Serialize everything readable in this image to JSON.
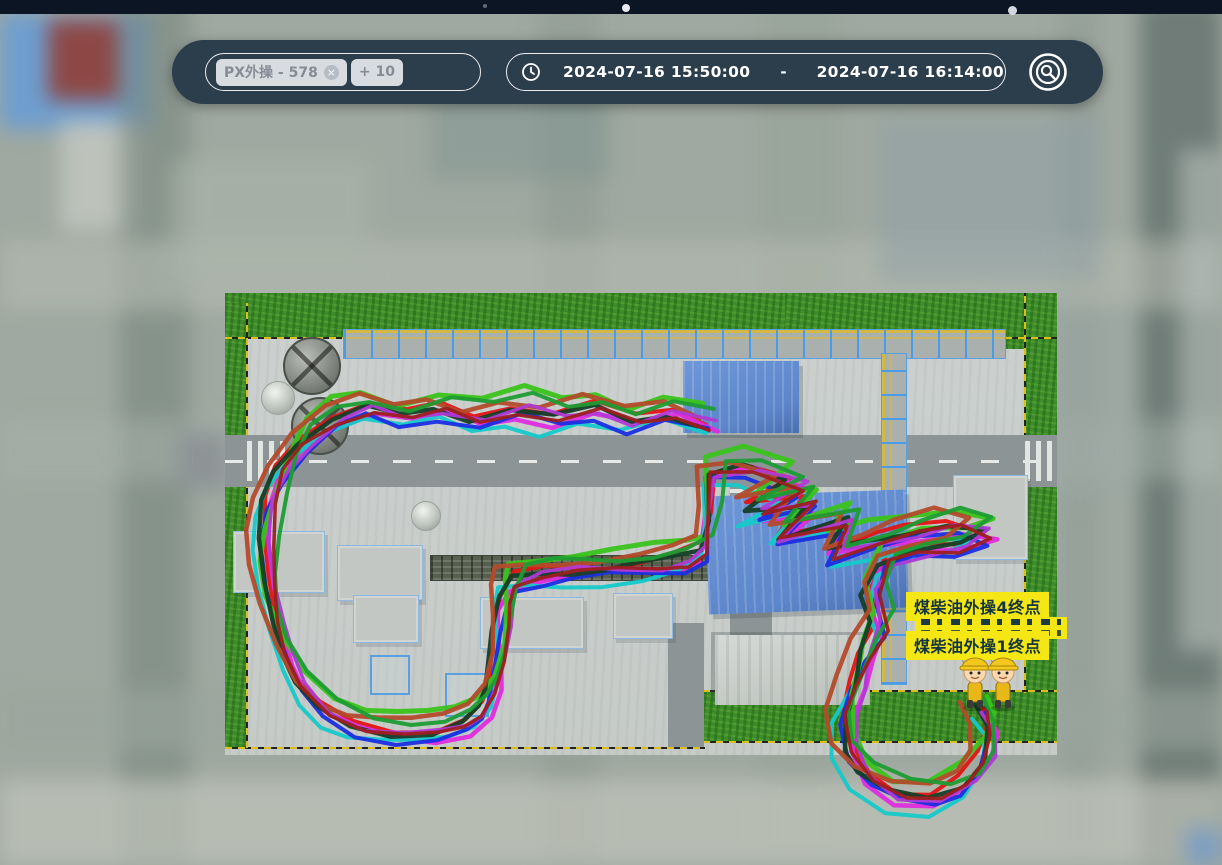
{
  "toolbar": {
    "person_filter": {
      "tag": "PX外操 - 578",
      "remove_icon": "×",
      "more_badge": "+ 10"
    },
    "time_range": {
      "start": "2024-07-16 15:50:00",
      "separator": "-",
      "end": "2024-07-16 16:14:00"
    }
  },
  "map": {
    "endpoint_labels": {
      "label_4": "煤柴油外操4终点",
      "label_1": "煤柴油外操1终点",
      "clipped_rows": 2
    },
    "workers_count": 2,
    "colors": {
      "label_bg": "#f5e713",
      "label_text": "#143441",
      "toolbar_bg": "#2c3d4c",
      "topbar_bg": "#0b1524",
      "grass": "#3f8c2b",
      "blue_roof": "#5d86cb"
    },
    "trajectories": {
      "base_points": [
        [
          706,
          420
        ],
        [
          668,
          408
        ],
        [
          630,
          417
        ],
        [
          592,
          405
        ],
        [
          554,
          414
        ],
        [
          516,
          404
        ],
        [
          478,
          413
        ],
        [
          440,
          404
        ],
        [
          402,
          414
        ],
        [
          364,
          405
        ],
        [
          330,
          414
        ],
        [
          300,
          436
        ],
        [
          281,
          466
        ],
        [
          270,
          500
        ],
        [
          264,
          538
        ],
        [
          264,
          576
        ],
        [
          270,
          614
        ],
        [
          282,
          650
        ],
        [
          300,
          682
        ],
        [
          326,
          706
        ],
        [
          358,
          721
        ],
        [
          394,
          728
        ],
        [
          430,
          729
        ],
        [
          460,
          721
        ],
        [
          480,
          706
        ],
        [
          492,
          684
        ],
        [
          497,
          656
        ],
        [
          498,
          624
        ],
        [
          500,
          596
        ],
        [
          509,
          576
        ],
        [
          540,
          569
        ],
        [
          576,
          566
        ],
        [
          612,
          564
        ],
        [
          648,
          561
        ],
        [
          678,
          556
        ],
        [
          700,
          546
        ],
        [
          706,
          512
        ],
        [
          709,
          468
        ],
        [
          748,
          463
        ],
        [
          794,
          480
        ],
        [
          752,
          507
        ],
        [
          808,
          498
        ],
        [
          776,
          533
        ],
        [
          846,
          516
        ],
        [
          830,
          549
        ],
        [
          874,
          537
        ],
        [
          908,
          528
        ],
        [
          952,
          519
        ],
        [
          986,
          528
        ],
        [
          958,
          543
        ],
        [
          916,
          547
        ],
        [
          882,
          557
        ],
        [
          869,
          588
        ],
        [
          878,
          620
        ],
        [
          864,
          650
        ],
        [
          854,
          682
        ],
        [
          843,
          712
        ],
        [
          846,
          744
        ],
        [
          864,
          770
        ],
        [
          896,
          790
        ],
        [
          934,
          795
        ],
        [
          964,
          780
        ],
        [
          982,
          754
        ],
        [
          986,
          724
        ],
        [
          978,
          704
        ]
      ],
      "series": [
        {
          "name": "red",
          "color": "#e41414",
          "width": 4,
          "dx": 0,
          "dy": 0,
          "amp": 6,
          "freq": 0.9,
          "phase": 0
        },
        {
          "name": "magenta",
          "color": "#df2cdf",
          "width": 4.5,
          "dx": 5,
          "dy": 10,
          "amp": 7,
          "freq": 0.8,
          "phase": 1.3
        },
        {
          "name": "cyan",
          "color": "#15c9c9",
          "width": 4,
          "dx": -7,
          "dy": 17,
          "amp": 8,
          "freq": 0.7,
          "phase": 2.2
        },
        {
          "name": "blue",
          "color": "#1b2ee0",
          "width": 4,
          "dx": 2,
          "dy": 13,
          "amp": 6,
          "freq": 1.05,
          "phase": 3.1
        },
        {
          "name": "bright-green",
          "color": "#3ac31b",
          "width": 5,
          "dx": 2,
          "dy": -13,
          "amp": 7,
          "freq": 0.85,
          "phase": 4.0
        },
        {
          "name": "dark-green",
          "color": "#153f27",
          "width": 4.5,
          "dx": -3,
          "dy": 4,
          "amp": 6,
          "freq": 0.95,
          "phase": 5.2
        },
        {
          "name": "rust",
          "color": "#b34b2b",
          "width": 4.5,
          "dx": -11,
          "dy": -6,
          "amp": 7,
          "freq": 0.75,
          "phase": 0.7
        },
        {
          "name": "orchid",
          "color": "#b139d6",
          "width": 3.5,
          "dx": 8,
          "dy": 5,
          "amp": 6,
          "freq": 1.1,
          "phase": 2.8
        },
        {
          "name": "mid-green",
          "color": "#1e9c33",
          "width": 4,
          "dx": 11,
          "dy": -7,
          "amp": 6,
          "freq": 0.8,
          "phase": 3.7
        },
        {
          "name": "crimson",
          "color": "#9c1f1f",
          "width": 3.5,
          "dx": 6,
          "dy": 7,
          "amp": 5,
          "freq": 1.0,
          "phase": 5.7
        }
      ]
    }
  }
}
